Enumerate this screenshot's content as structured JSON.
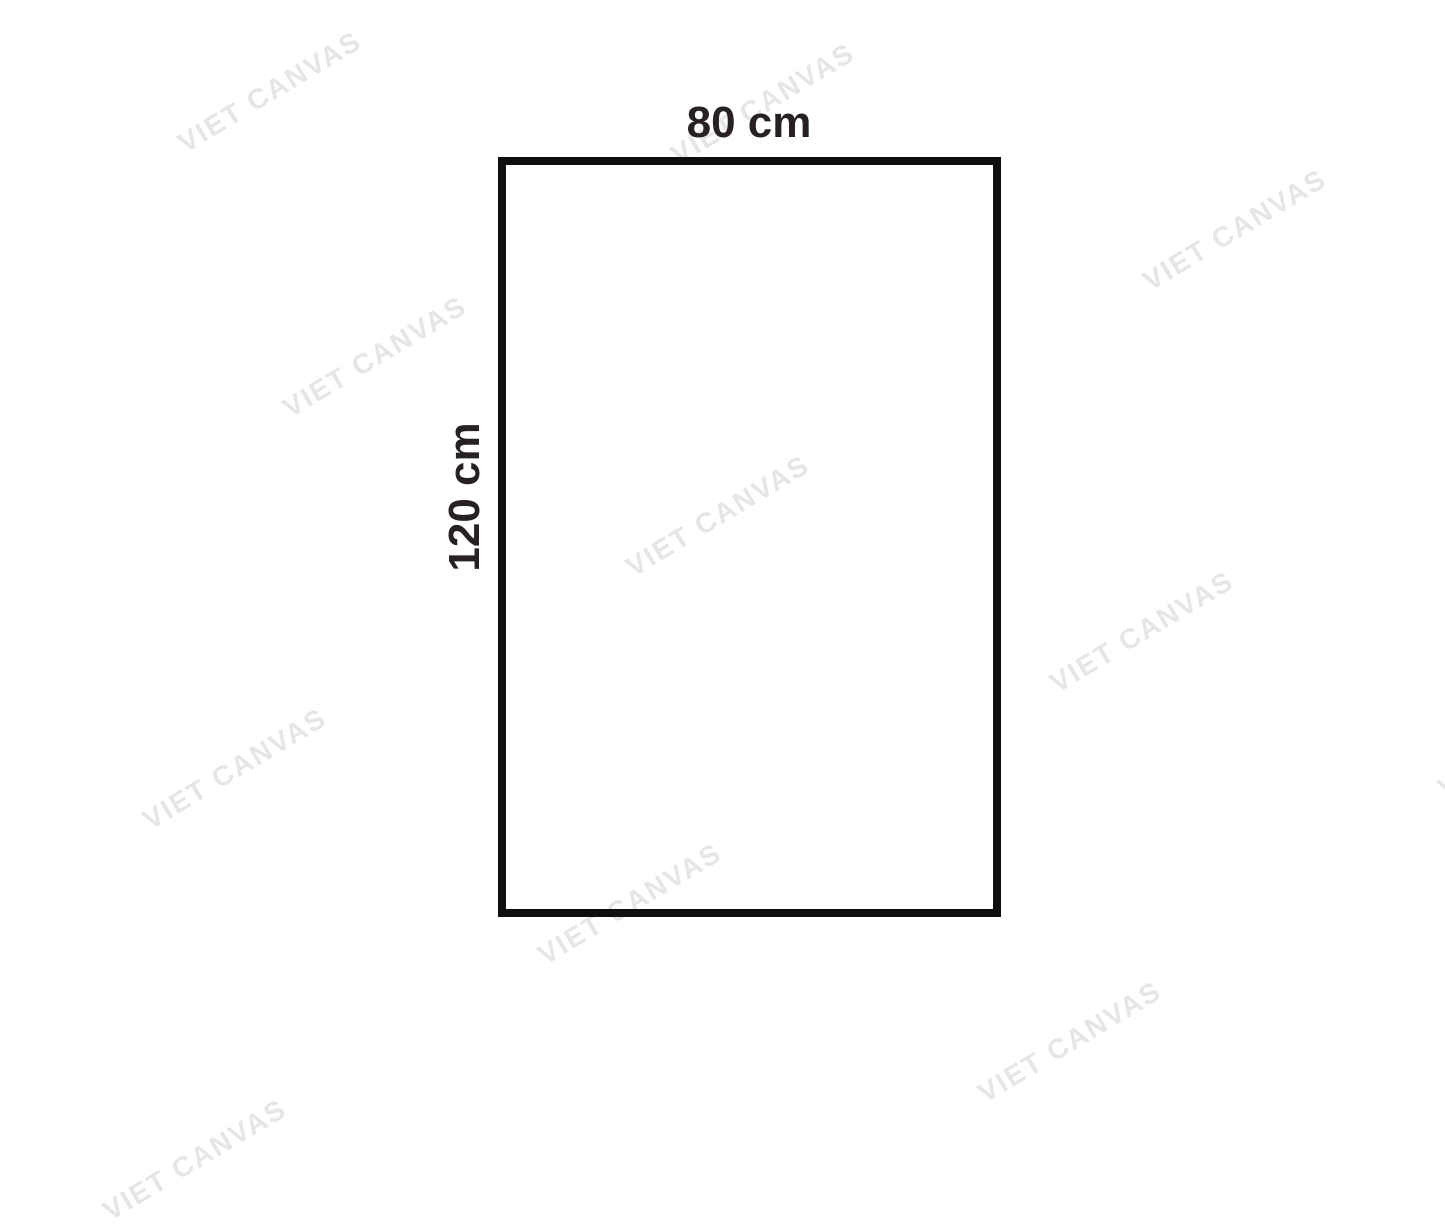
{
  "page": {
    "width_px": 1445,
    "height_px": 1156,
    "background_color": "#ffffff"
  },
  "diagram": {
    "shape": "rectangle",
    "width_label": "80 cm",
    "height_label": "120 cm",
    "border_color": "#0e0e0e",
    "label_color": "#272123"
  },
  "watermark": {
    "text": "VIET CANVAS",
    "color": "#e7e6e6",
    "angle_deg": -31,
    "positions": [
      {
        "x": 270,
        "y": 92
      },
      {
        "x": 763,
        "y": 104
      },
      {
        "x": 1235,
        "y": 230
      },
      {
        "x": 375,
        "y": 357
      },
      {
        "x": 718,
        "y": 516
      },
      {
        "x": 1142,
        "y": 632
      },
      {
        "x": 235,
        "y": 769
      },
      {
        "x": 630,
        "y": 904
      },
      {
        "x": 1070,
        "y": 1042
      },
      {
        "x": 195,
        "y": 1160
      },
      {
        "x": 1530,
        "y": 737
      }
    ]
  }
}
